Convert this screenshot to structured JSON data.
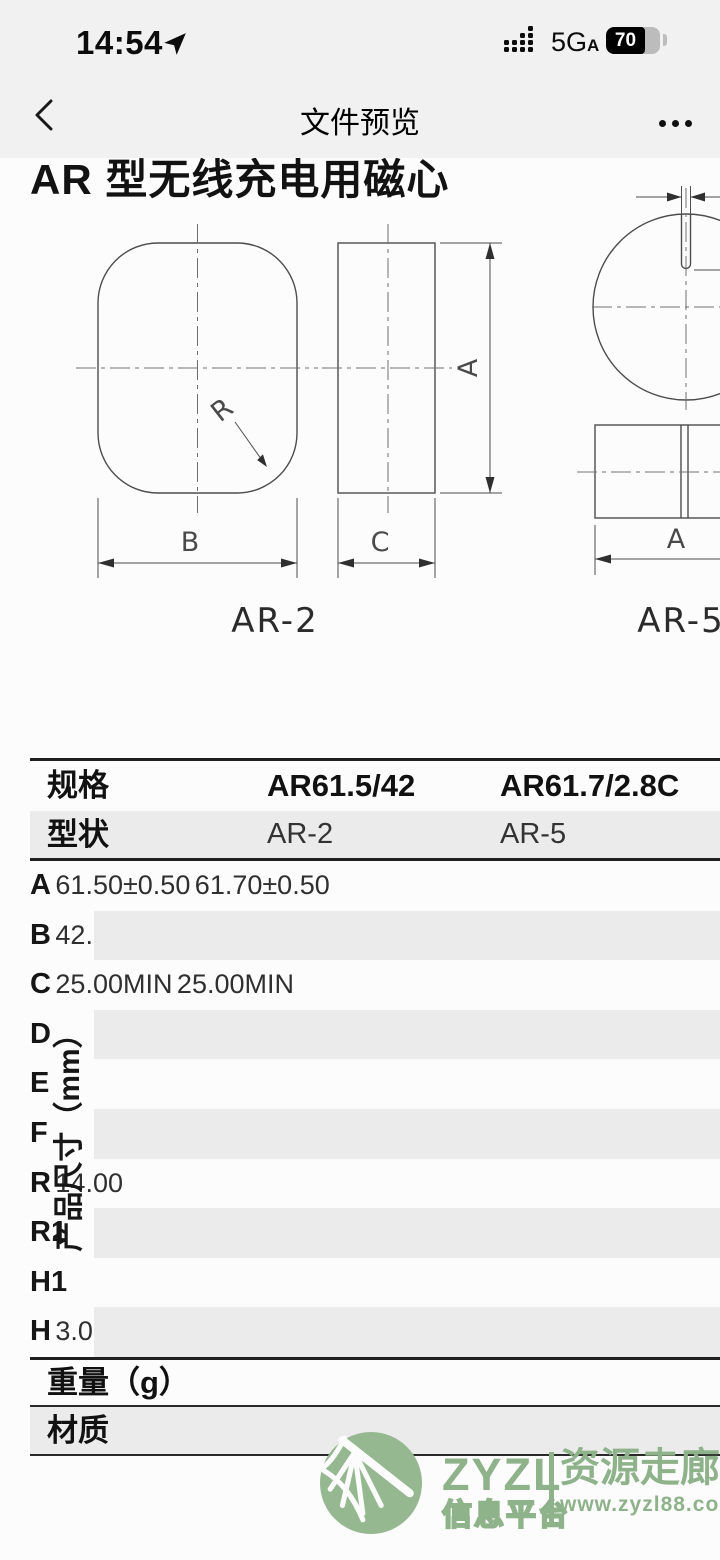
{
  "status_bar": {
    "time": "14:54",
    "network": "5G",
    "network_sub": "A",
    "battery_percent": "70",
    "icons": {
      "location": "location-arrow-icon",
      "signal": "signal-strength-icon",
      "battery": "battery-icon"
    }
  },
  "nav_bar": {
    "title": "文件预览",
    "icons": {
      "back": "back-chevron-icon",
      "more": "more-options-icon"
    }
  },
  "document": {
    "title": "AR 型无线充电用磁心",
    "drawing": {
      "left_shape_label": "AR-2",
      "right_shape_label": "AR-5",
      "dim_b": "B",
      "dim_c": "C",
      "dim_a_side": "A",
      "dim_r": "R",
      "dim_a_bottom": "A"
    },
    "table": {
      "spec_row": {
        "label": "规格",
        "values": [
          "AR61.5/42",
          "AR61.7/2.8C"
        ]
      },
      "shape_row": {
        "label": "型状",
        "values": [
          "AR-2",
          "AR-5"
        ]
      },
      "group_label": "产品尺寸（mm）",
      "dimension_rows": [
        {
          "param": "A",
          "values": [
            "61.50±0.50",
            "61.70±0.50"
          ]
        },
        {
          "param": "B",
          "values": [
            "42.00±0.40",
            "2.80±0.30"
          ]
        },
        {
          "param": "C",
          "values": [
            "25.00MIN",
            "25.00MIN"
          ]
        },
        {
          "param": "D",
          "values": [
            "",
            ""
          ]
        },
        {
          "param": "E",
          "values": [
            "",
            ""
          ]
        },
        {
          "param": "F",
          "values": [
            "",
            ""
          ]
        },
        {
          "param": "R",
          "values": [
            "14.00",
            ""
          ]
        },
        {
          "param": "R1",
          "values": [
            "",
            ""
          ]
        },
        {
          "param": "H1",
          "values": [
            "",
            ""
          ]
        },
        {
          "param": "H",
          "values": [
            "",
            "3.00"
          ]
        }
      ],
      "weight_row_label": "重量（g）",
      "material_row_label": "材质"
    },
    "watermark": {
      "brand": "ZYZL",
      "brand_sub": "信息平台",
      "site_name": "资源走廊",
      "url": "www.zyzl88.com",
      "green": "#8eb289",
      "ball_green": "#95b890"
    }
  },
  "colors": {
    "topbar_bg": "#f2f1f2",
    "doc_bg": "#fcfcfc",
    "table_stripe": "#ecebec",
    "line": "#4d4d4d"
  }
}
